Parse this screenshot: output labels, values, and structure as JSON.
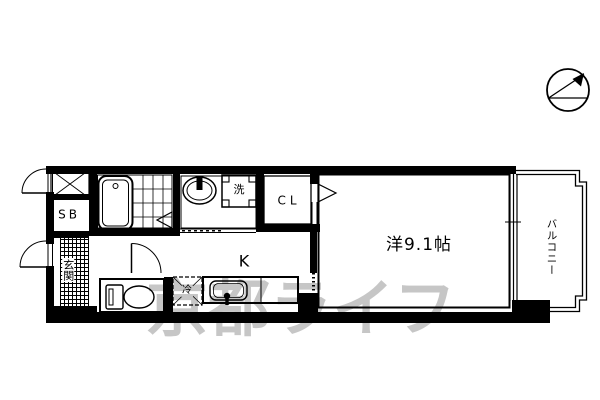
{
  "floorplan": {
    "rooms": {
      "western_room": {
        "label": "洋9.1帖"
      },
      "kitchen": {
        "label": "K"
      },
      "balcony": {
        "label": "バルコニー"
      },
      "entrance": {
        "label": "玄関"
      },
      "closet": {
        "label": "CL"
      },
      "shoe_box": {
        "label": "SB"
      }
    },
    "fixtures": {
      "washer_pan": {
        "label": "洗"
      },
      "refrigerator": {
        "label": "冷"
      }
    },
    "watermark": {
      "text": "京都ライフ",
      "color": "#c6c6c6"
    },
    "compass": {
      "icon": "north-arrow"
    }
  },
  "colors": {
    "background": "#ffffff",
    "line": "#000000"
  }
}
